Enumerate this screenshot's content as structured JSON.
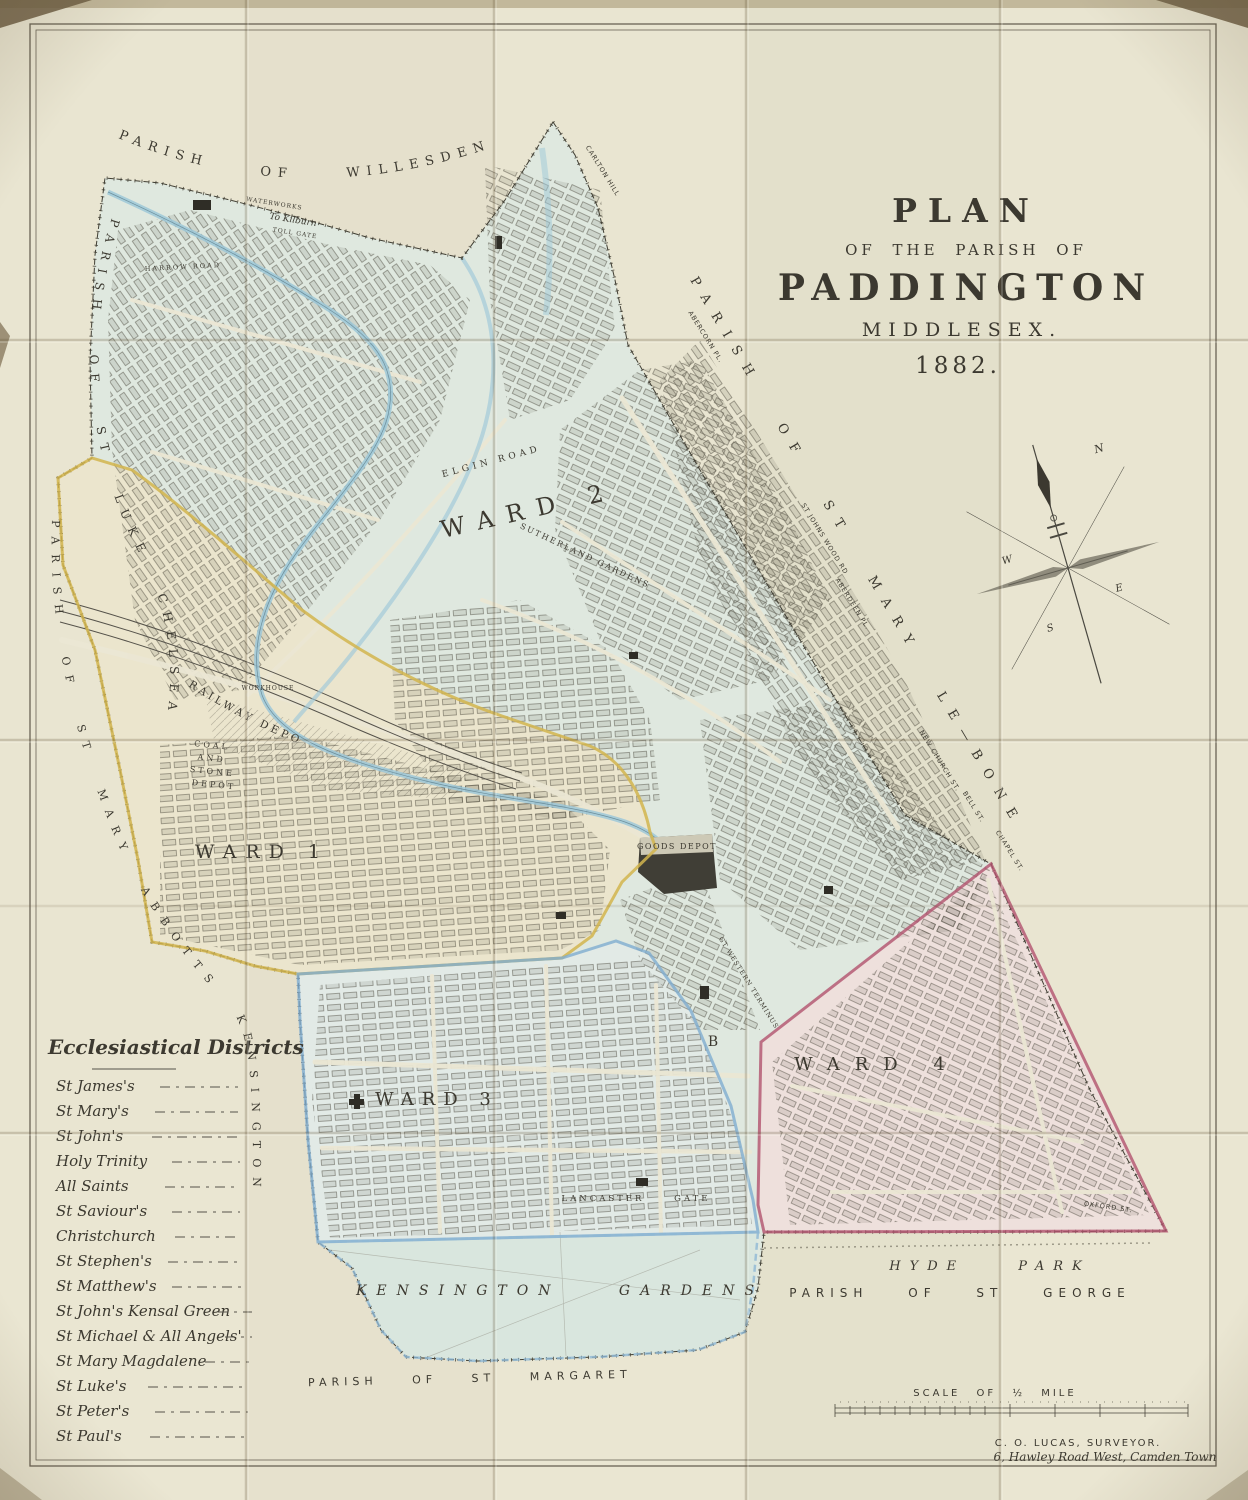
{
  "title": {
    "l1": "PLAN",
    "l2": "OF THE PARISH OF",
    "l3": "PADDINGTON",
    "l4": "MIDDLESEX.",
    "l5": "1882."
  },
  "neighbors": {
    "willesden": "PARISH OF WILLESDEN",
    "st_luke_chelsea": "PARISH OF ST LUKE CHELSEA",
    "st_mary_abbotts": "PARISH OF ST MARY ABBOTTS KENSINGTON",
    "st_mary_le_bone": "PARISH OF ST MARY LE—BONE",
    "st_george": "PARISH OF ST GEORGE",
    "st_margaret": "PARISH OF ST MARGARET"
  },
  "wards": {
    "ward1": "WARD 1",
    "ward2": "WARD 2",
    "ward3": "WARD 3",
    "ward4": "WARD 4"
  },
  "places": {
    "railway_depot": "RAILWAY DEPOT",
    "coal_line1": "COAL",
    "coal_line2": "AND",
    "coal_line3": "STONE",
    "coal_line4": "DEPOT",
    "goods_depot": "GOODS DEPOT",
    "workhouse": "WORKHOUSE",
    "kensington_gardens": "KENSINGTON GARDENS",
    "hyde_park": "HYDE PARK",
    "lancaster_gate": "LANCASTER GATE",
    "elgin_road": "ELGIN ROAD",
    "sutherland_gardens": "SUTHERLAND GARDENS",
    "harrow_road": "HARROW ROAD",
    "waterworks": "WATERWORKS",
    "to_kilburn": "To Kilburn",
    "toll_gate": "TOLL GATE",
    "gt_western_terminus": "GT WESTERN TERMINUS",
    "panel_letter": "B"
  },
  "boundary_streets": [
    "CARLTON HILL",
    "ABERCORN PL.",
    "ST JOHNS WOOD RD",
    "ABERDEEN PL.",
    "NEW CHURCH ST.",
    "BELL ST.",
    "CHAPEL ST.",
    "OXFORD ST."
  ],
  "compass": {
    "n": "N",
    "e": "E",
    "s": "S",
    "w": "W"
  },
  "scale_bar": {
    "label": "SCALE OF ½ MILE"
  },
  "surveyor": {
    "line1": "C. O. LUCAS, SURVEYOR.",
    "line2": "6, Hawley Road West, Camden Town"
  },
  "legend": {
    "heading": "Ecclesiastical Districts",
    "items": [
      "St James's",
      "St Mary's",
      "St John's",
      "Holy Trinity",
      "All Saints",
      "St Saviour's",
      "Christchurch",
      "St Stephen's",
      "St Matthew's",
      "St John's Kensal Green",
      "St Michael & All Angels'",
      "St Mary Magdalene",
      "St Luke's",
      "St Peter's",
      "St Paul's"
    ]
  },
  "colors": {
    "paper": "#e9e5d1",
    "map_tint": "#dfe8df",
    "ward1_fill": "#ebe5cd",
    "ward3_fill": "#e2eae6",
    "ward4_fill": "#eee0dc",
    "gardens_fill": "#d9e6de",
    "water": "#9ec8d8",
    "ward1_boundary": "#d2b54e",
    "ward3_boundary": "#7fadd0",
    "ward4_boundary": "#b2526e",
    "ink": "#3c3930"
  }
}
